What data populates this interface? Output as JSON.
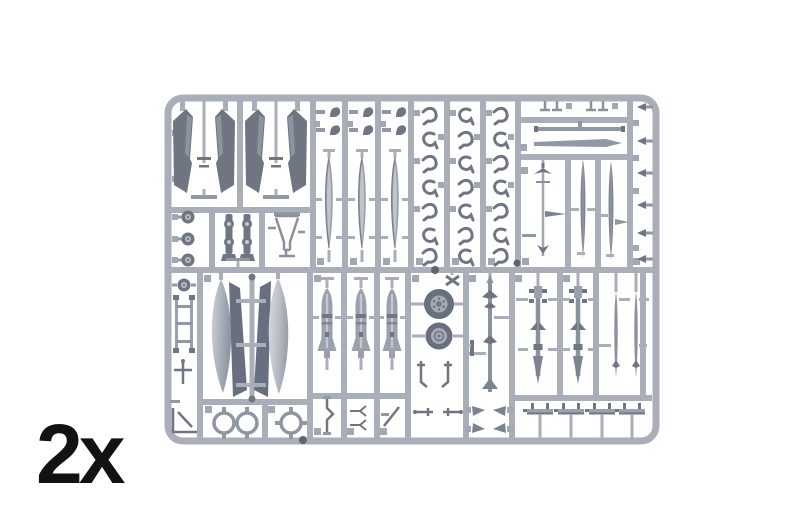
{
  "image": {
    "subject": "Plastic scale-model kit sprue - light grey injection-molded parts frame on a white background",
    "quantity_label": "2x",
    "background_color": "#ffffff",
    "label_color": "#121212",
    "plastic_colors": {
      "runner_frame": "#a9aeb8",
      "part_light": "#b9bdc6",
      "part_mid": "#9098a4",
      "part_dark": "#6f7682"
    },
    "visible_part_shapes": [
      "tail-fin-halves",
      "small-wheels",
      "gear-struts",
      "intake-duct",
      "slim-tank-halves",
      "gear-door-hinges",
      "antenna-strips",
      "blade-antennas",
      "edge-fittings",
      "left-column-linkages",
      "large-drop-tank-halves",
      "mounting-rings",
      "bombs",
      "main-wheels",
      "sidewinder-missile",
      "sparrow-missiles",
      "slender-missiles",
      "underwing-pylons"
    ]
  }
}
